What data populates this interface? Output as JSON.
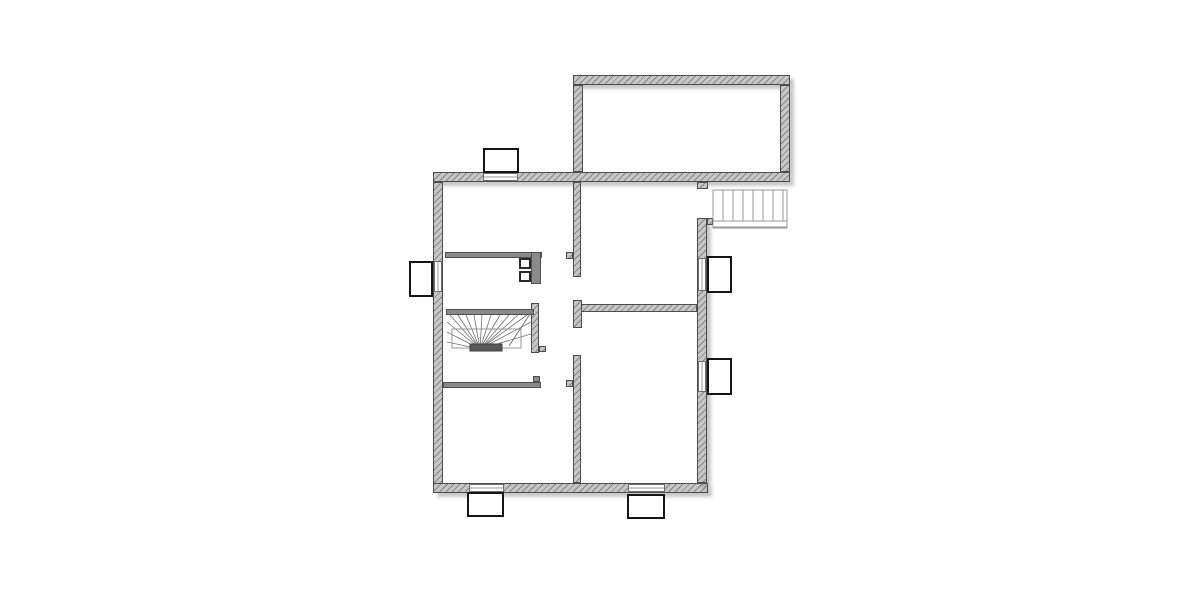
{
  "canvas": {
    "width": 1200,
    "height": 600,
    "background": "#ffffff"
  },
  "palette": {
    "wall_fill": "#c6c6c6",
    "wall_hatch": "#464646",
    "wall_edge": "#4d4d4d",
    "thin_wall_fill": "#8a8a8a",
    "window_fill": "#ffffff",
    "window_edge": "#141414",
    "stair_line": "#979797",
    "winder_line": "#6f6f6f",
    "winder_tread_fill": "#5a5a5a",
    "shadow": "rgba(110,110,110,0.38)"
  },
  "plan": {
    "walls": [
      {
        "name": "upper-room-top-wall",
        "type": "ext",
        "x": 573,
        "y": 75,
        "w": 217,
        "h": 10,
        "shadow": true
      },
      {
        "name": "upper-room-right-wall",
        "type": "ext",
        "x": 780,
        "y": 85,
        "w": 10,
        "h": 87,
        "shadow": true
      },
      {
        "name": "upper-room-left-wall",
        "type": "ext",
        "x": 573,
        "y": 85,
        "w": 10,
        "h": 87,
        "shadow": false
      },
      {
        "name": "main-top-wall",
        "type": "ext",
        "x": 433,
        "y": 172,
        "w": 357,
        "h": 10,
        "shadow": true
      },
      {
        "name": "left-wall",
        "type": "ext",
        "x": 433,
        "y": 182,
        "w": 10,
        "h": 311,
        "shadow": false
      },
      {
        "name": "bottom-wall",
        "type": "ext",
        "x": 433,
        "y": 483,
        "w": 275,
        "h": 10,
        "shadow": true
      },
      {
        "name": "right-wall",
        "type": "ext",
        "x": 697,
        "y": 218,
        "w": 10,
        "h": 265,
        "shadow": true
      },
      {
        "name": "entry-notch",
        "type": "ext",
        "x": 697,
        "y": 182,
        "w": 11,
        "h": 7,
        "shadow": false
      },
      {
        "name": "right-wall-top-tick",
        "type": "ext",
        "x": 707,
        "y": 218,
        "w": 6,
        "h": 7,
        "shadow": false
      },
      {
        "name": "mid-wall-upper",
        "type": "ext",
        "x": 573,
        "y": 182,
        "w": 8,
        "h": 95,
        "shadow": false
      },
      {
        "name": "mid-wall-upper-tick",
        "type": "ext",
        "x": 566,
        "y": 252,
        "w": 7,
        "h": 7,
        "shadow": false
      },
      {
        "name": "mid-wall-cap",
        "type": "ext",
        "x": 573,
        "y": 300,
        "w": 9,
        "h": 28,
        "shadow": false
      },
      {
        "name": "mid-horizontal-wall",
        "type": "ext",
        "x": 581,
        "y": 304,
        "w": 116,
        "h": 8,
        "shadow": false
      },
      {
        "name": "mid-wall-lower",
        "type": "ext",
        "x": 573,
        "y": 355,
        "w": 8,
        "h": 128,
        "shadow": false
      },
      {
        "name": "mid-wall-lower-tick",
        "type": "ext",
        "x": 566,
        "y": 380,
        "w": 7,
        "h": 7,
        "shadow": false
      },
      {
        "name": "stair-side-wall",
        "type": "ext",
        "x": 531,
        "y": 303,
        "w": 8,
        "h": 50,
        "shadow": false
      },
      {
        "name": "stair-side-wall-tick",
        "type": "ext",
        "x": 539,
        "y": 346,
        "w": 7,
        "h": 6,
        "shadow": false
      },
      {
        "name": "upper-partition-wall",
        "type": "thin",
        "x": 445,
        "y": 252,
        "w": 97,
        "h": 6,
        "shadow": false
      },
      {
        "name": "chimney-stack",
        "type": "thin",
        "x": 531,
        "y": 252,
        "w": 10,
        "h": 32,
        "shadow": false
      },
      {
        "name": "stair-top-beam",
        "type": "thin",
        "x": 446,
        "y": 309,
        "w": 88,
        "h": 6,
        "shadow": false
      },
      {
        "name": "lower-partition-wall",
        "type": "thin",
        "x": 443,
        "y": 382,
        "w": 98,
        "h": 6,
        "shadow": false
      },
      {
        "name": "lower-partition-hook",
        "type": "thin",
        "x": 533,
        "y": 376,
        "w": 7,
        "h": 6,
        "shadow": false
      }
    ],
    "glazings": [
      {
        "name": "window-glazing-top",
        "orient": "h",
        "x": 483,
        "y": 173,
        "w": 35,
        "h": 8
      },
      {
        "name": "window-glazing-left",
        "orient": "v",
        "x": 434,
        "y": 261,
        "w": 8,
        "h": 31
      },
      {
        "name": "window-glazing-right-upper",
        "orient": "v",
        "x": 698,
        "y": 258,
        "w": 8,
        "h": 33
      },
      {
        "name": "window-glazing-right-lower",
        "orient": "v",
        "x": 698,
        "y": 361,
        "w": 8,
        "h": 31
      },
      {
        "name": "window-glazing-bottom-left",
        "orient": "h",
        "x": 469,
        "y": 484,
        "w": 35,
        "h": 8
      },
      {
        "name": "window-glazing-bottom-mid",
        "orient": "h",
        "x": 628,
        "y": 484,
        "w": 37,
        "h": 8
      }
    ],
    "window_boxes": [
      {
        "name": "window-box-top",
        "x": 483,
        "y": 148,
        "w": 36,
        "h": 25
      },
      {
        "name": "window-box-left",
        "x": 409,
        "y": 261,
        "w": 24,
        "h": 36
      },
      {
        "name": "window-box-right-upper",
        "x": 707,
        "y": 256,
        "w": 25,
        "h": 37
      },
      {
        "name": "window-box-right-lower",
        "x": 707,
        "y": 358,
        "w": 25,
        "h": 37
      },
      {
        "name": "window-box-bottom-left",
        "x": 467,
        "y": 492,
        "w": 37,
        "h": 25
      },
      {
        "name": "window-box-bottom-mid",
        "x": 627,
        "y": 494,
        "w": 38,
        "h": 25
      }
    ],
    "chimney_flues": [
      {
        "name": "chimney-flue-1",
        "x": 519,
        "y": 258,
        "w": 12,
        "h": 11
      },
      {
        "name": "chimney-flue-2",
        "x": 519,
        "y": 271,
        "w": 12,
        "h": 11
      }
    ],
    "exterior_stairs": {
      "name": "exterior-stairs",
      "x": 713,
      "y": 190,
      "w": 74,
      "h": 38,
      "tread_start": 723,
      "tread_step": 10,
      "tread_count": 7,
      "tread_bottom": 221,
      "band_y": 227
    },
    "winder_stairs": {
      "name": "winder-staircase",
      "center": [
        480,
        349
      ],
      "fan_top_y": 315,
      "fan_top_x": [
        450,
        458,
        466,
        474,
        482,
        491,
        500,
        509,
        518,
        527
      ],
      "fan_left_x": 447,
      "fan_left_y": [
        322,
        332,
        342
      ],
      "fan_right_x": 531,
      "fan_right_y": [
        322,
        334
      ],
      "inner_rect": [
        452,
        329,
        69,
        19
      ],
      "tread_bar": [
        470,
        344,
        32,
        7
      ],
      "cut_line": [
        [
          509,
          346
        ],
        [
          532,
          311
        ]
      ]
    }
  }
}
